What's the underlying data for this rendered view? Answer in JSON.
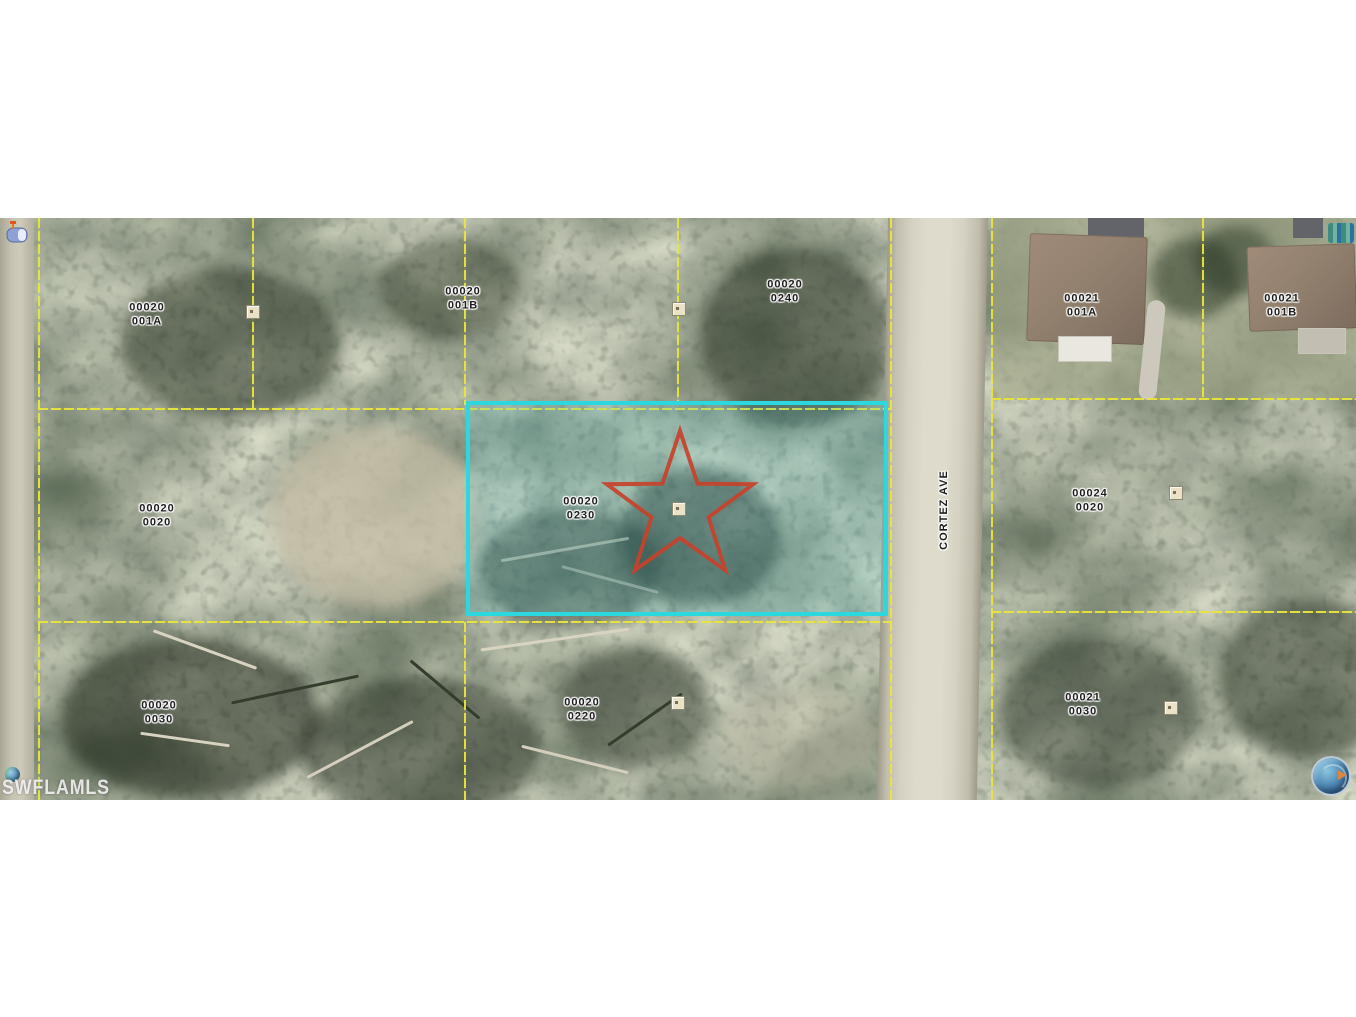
{
  "window": {
    "width": 1356,
    "height": 1017,
    "background": "#ffffff"
  },
  "map": {
    "type": "aerial-parcel-map",
    "street": {
      "name": "CORTEZ AVE"
    },
    "watermark": {
      "text": "SWFLAMLS"
    },
    "colors": {
      "parcel_boundary": "#e9e53c",
      "highlight_border": "#2cd8de",
      "highlight_fill": "rgba(80,205,215,0.20)",
      "star": "#c5422b",
      "road": "#dedacc",
      "vegetation_base": "#7f8672"
    },
    "highlighted_parcel": {
      "label_block": "00020",
      "label_lot": "0230"
    },
    "parcel_labels": [
      {
        "block": "00020",
        "lot": "001A",
        "x": 147,
        "y": 97
      },
      {
        "block": "00020",
        "lot": "001B",
        "x": 463,
        "y": 81
      },
      {
        "block": "00020",
        "lot": "0240",
        "x": 785,
        "y": 74
      },
      {
        "block": "00021",
        "lot": "001A",
        "x": 1082,
        "y": 88
      },
      {
        "block": "00021",
        "lot": "001B",
        "x": 1282,
        "y": 88
      },
      {
        "block": "00020",
        "lot": "0020",
        "x": 157,
        "y": 298
      },
      {
        "block": "00020",
        "lot": "0230",
        "x": 581,
        "y": 291
      },
      {
        "block": "00024",
        "lot": "0020",
        "x": 1090,
        "y": 283
      },
      {
        "block": "00020",
        "lot": "0030",
        "x": 159,
        "y": 495
      },
      {
        "block": "00020",
        "lot": "0220",
        "x": 582,
        "y": 492
      },
      {
        "block": "00021",
        "lot": "0030",
        "x": 1083,
        "y": 487
      }
    ],
    "survey_markers": [
      {
        "x": 679,
        "y": 91
      },
      {
        "x": 253,
        "y": 94
      },
      {
        "x": 679,
        "y": 291
      },
      {
        "x": 678,
        "y": 485
      },
      {
        "x": 1176,
        "y": 275
      },
      {
        "x": 1171,
        "y": 490
      }
    ],
    "icons": {
      "mailbox": "mailbox-icon",
      "watermark_globe": "globe-icon",
      "compass_globe": "compass-globe-icon",
      "star_marker": "property-star-marker"
    }
  }
}
